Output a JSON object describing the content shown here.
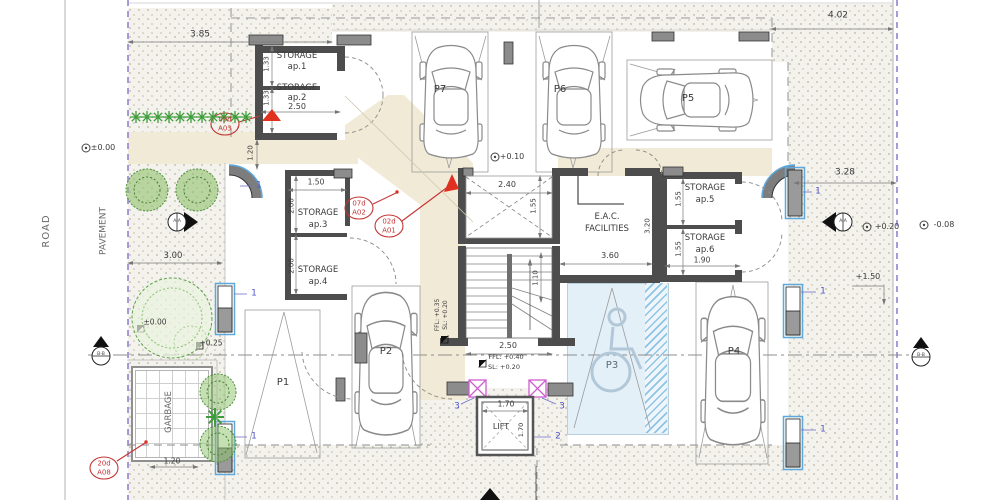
{
  "site": {
    "road": "ROAD",
    "pavement": "PAVEMENT",
    "garbage": "GARBAGE"
  },
  "parking": {
    "p1": "P1",
    "p2": "P2",
    "p3": "P3",
    "p4": "P4",
    "p5": "P5",
    "p6": "P6",
    "p7": "P7"
  },
  "rooms": {
    "storage": "STORAGE",
    "ap1": "ap.1",
    "ap2": "ap.2",
    "ap3": "ap.3",
    "ap4": "ap.4",
    "ap5": "ap.5",
    "ap6": "ap.6",
    "eac_line1": "E.A.C.",
    "eac_line2": "FACILITIES",
    "lift": "LIFT"
  },
  "dims": {
    "d385": "3.85",
    "d402": "4.02",
    "d328": "3.28",
    "d300": "3.00",
    "d133": "1.33",
    "d250": "2.50",
    "d120": "1.20",
    "d150": "1.50",
    "d200": "2.00",
    "d240": "2.40",
    "d155": "1.55",
    "d110": "1.10",
    "d360": "3.60",
    "d320": "3.20",
    "d190": "1.90",
    "d170": "1.70",
    "d150p": "+1.50"
  },
  "levels": {
    "l0": "±0.00",
    "l010": "+0.10",
    "l020": "+0.20",
    "l008": "-0.08",
    "l025": "+0.25",
    "ffl35": "FFL: +0.35",
    "ffl40": "FFL: +0.40",
    "sl20": "SL: +0.20"
  },
  "tags": {
    "t1a": "09d",
    "t1b": "A03",
    "t2a": "07d",
    "t2b": "A02",
    "t3a": "02d",
    "t3b": "A01",
    "t4a": "20d",
    "t4b": "A08"
  },
  "markers": {
    "aa": "A-A",
    "bb": "B-B",
    "c1": "1",
    "c2": "2",
    "c3": "3"
  }
}
